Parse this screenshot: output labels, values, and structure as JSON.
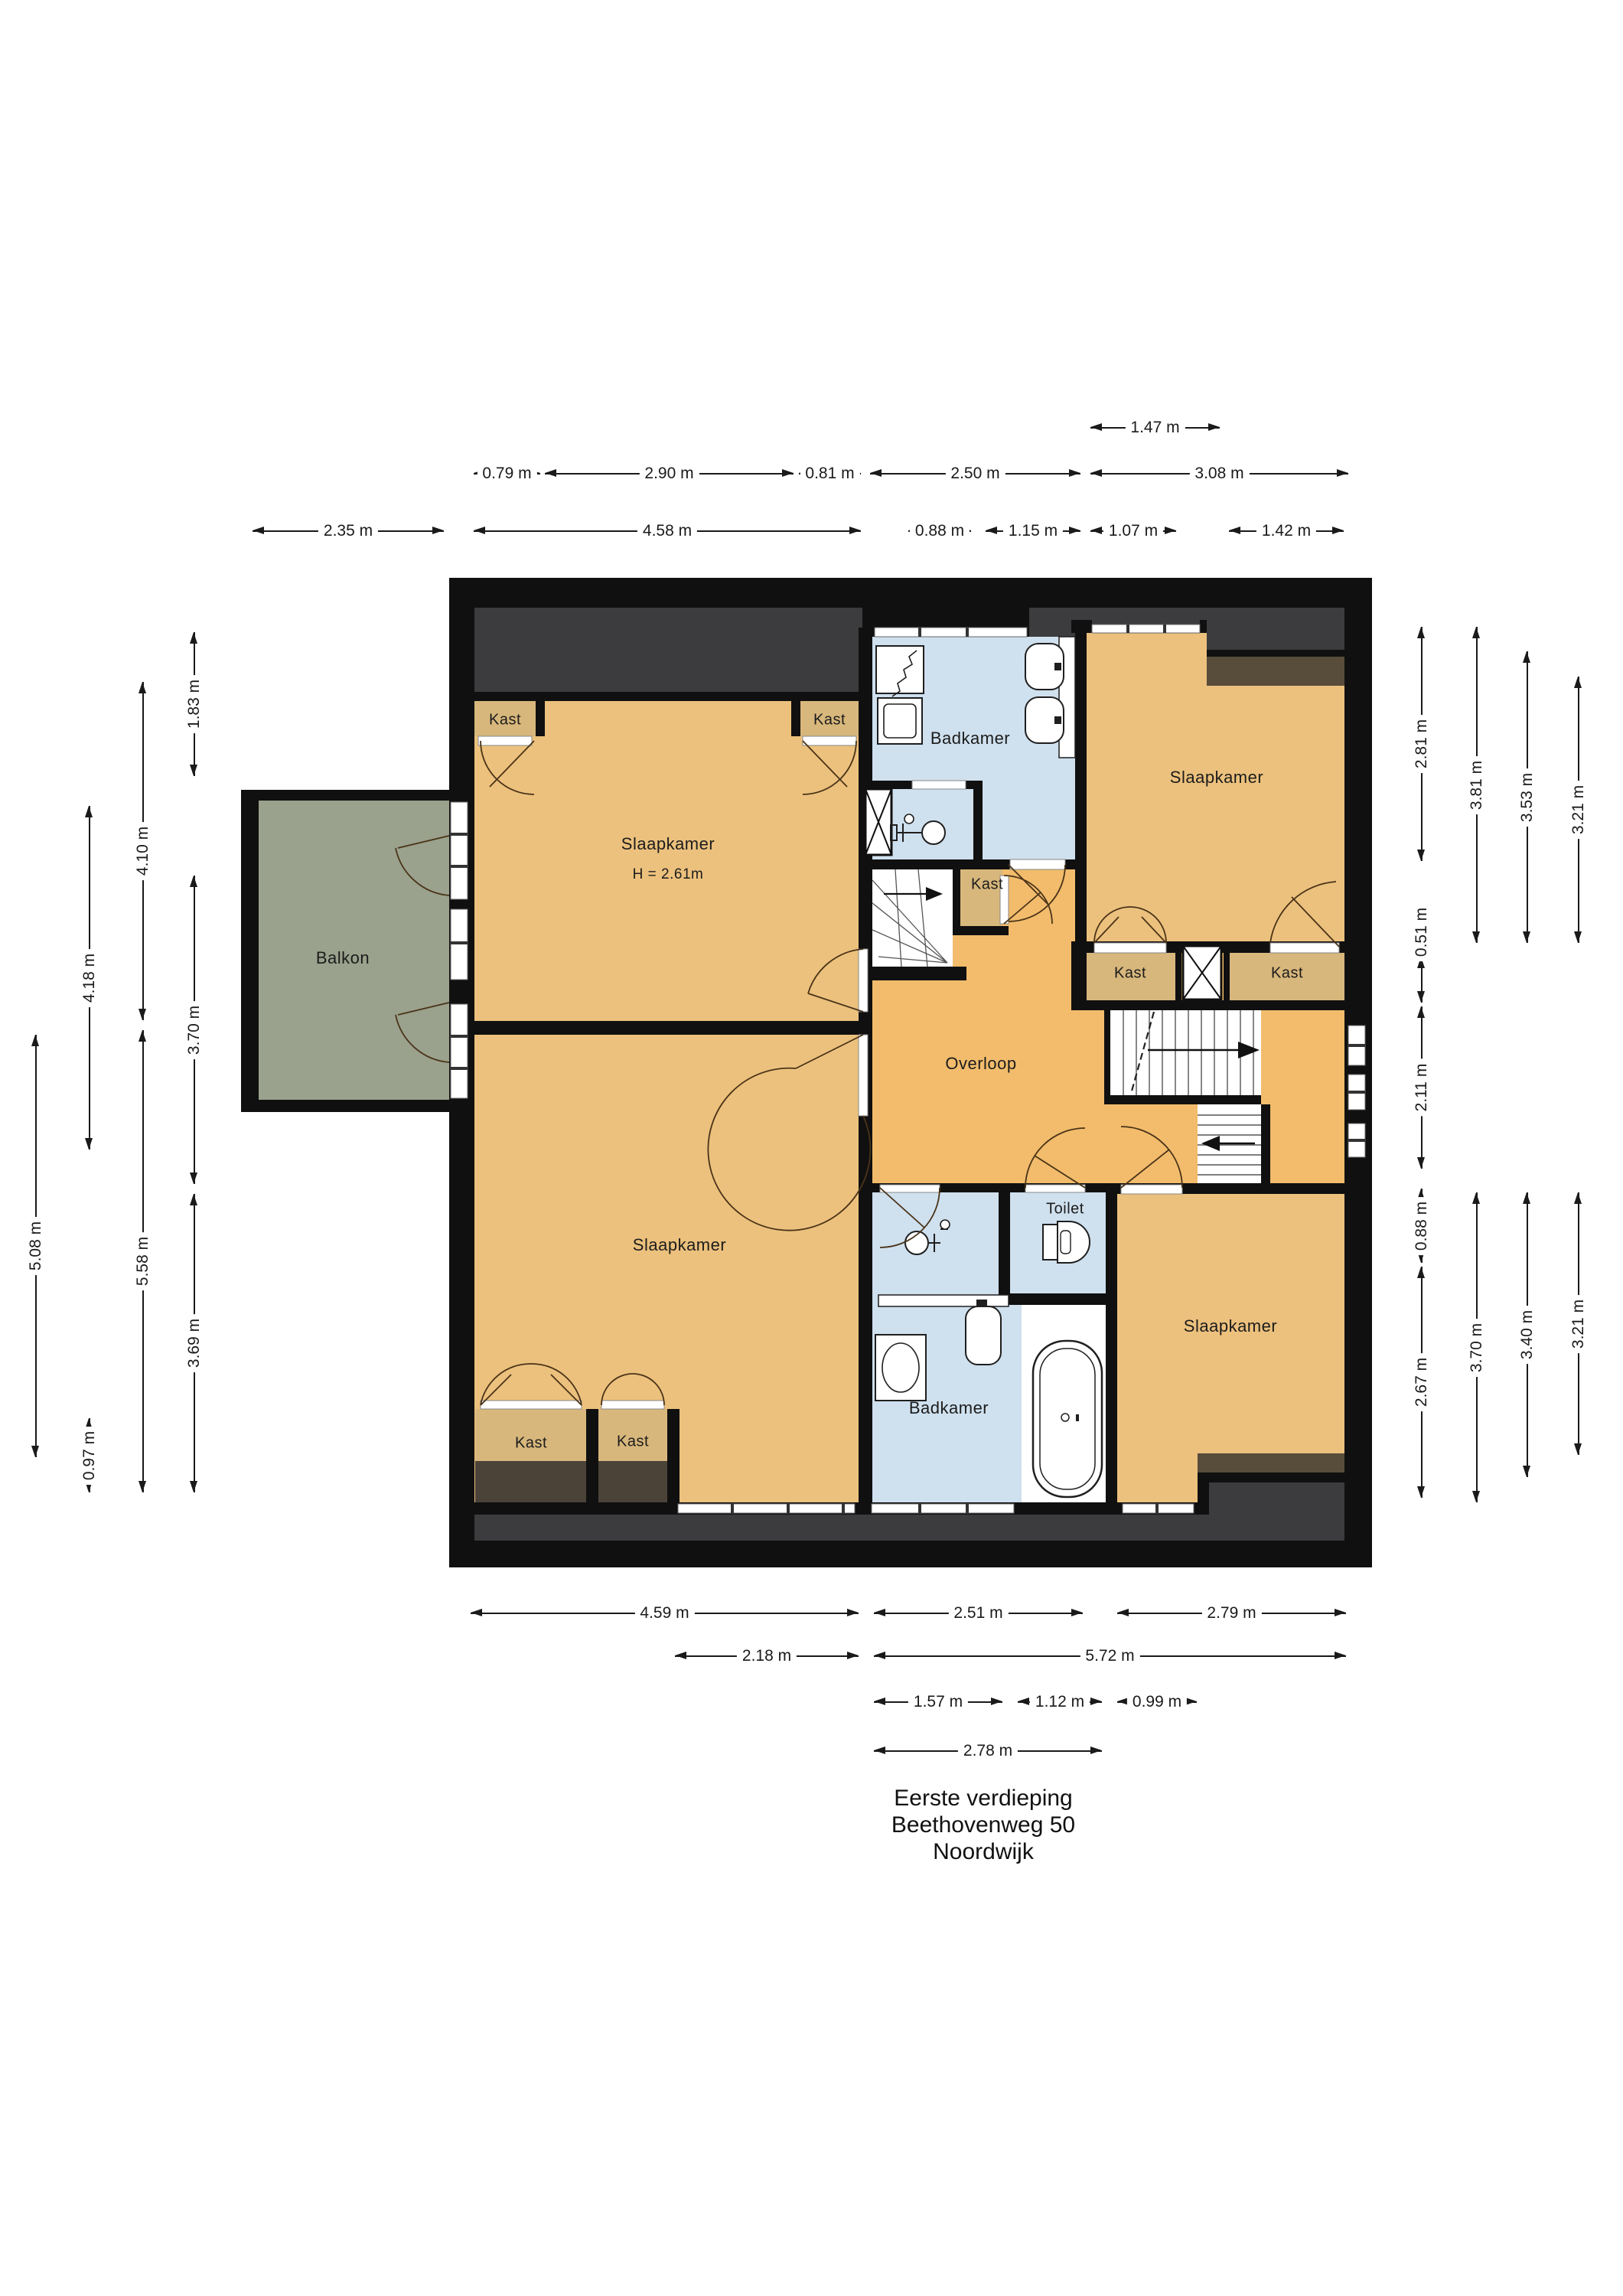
{
  "title": {
    "line1": "Eerste verdieping",
    "line2": "Beethovenweg 50",
    "line3": "Noordwijk"
  },
  "rooms": {
    "slaapkamer_tl": "Slaapkamer",
    "slaapkamer_tl_height": "H = 2.61m",
    "slaapkamer_tr": "Slaapkamer",
    "slaapkamer_bl": "Slaapkamer",
    "slaapkamer_br": "Slaapkamer",
    "badkamer_top": "Badkamer",
    "badkamer_bottom": "Badkamer",
    "overloop": "Overloop",
    "toilet": "Toilet",
    "balkon": "Balkon",
    "kast": "Kast"
  },
  "dimensions": {
    "top": [
      "1.47 m",
      "0.79 m",
      "2.90 m",
      "0.81 m",
      "2.50 m",
      "3.08 m",
      "2.35 m",
      "4.58 m",
      "0.88 m",
      "1.15 m",
      "1.07 m",
      "1.42 m"
    ],
    "bottom": [
      "4.59 m",
      "2.51 m",
      "2.79 m",
      "2.18 m",
      "5.72 m",
      "1.57 m",
      "1.12 m",
      "0.99 m",
      "2.78 m"
    ],
    "left": [
      "1.83 m",
      "4.10 m",
      "4.18 m",
      "3.70 m",
      "5.08 m",
      "5.58 m",
      "3.69 m",
      "0.97 m"
    ],
    "right": [
      "2.81 m",
      "3.81 m",
      "3.53 m",
      "3.21 m",
      "0.51 m",
      "2.11 m",
      "0.88 m",
      "2.67 m",
      "3.70 m",
      "3.40 m",
      "3.21 m"
    ]
  },
  "fixtures": [
    "shower",
    "washing-machine",
    "sink",
    "double-sink",
    "bathtub",
    "toilet-bowl",
    "mixer-tap",
    "stairs-up",
    "stairs-down",
    "winder-stairs",
    "shaft",
    "window",
    "door"
  ],
  "colors": {
    "wall": "#101010",
    "roof": "#3c3c3e",
    "roofbrown": "#584c3a",
    "underbrown": "#4c4338",
    "tan": "#ecc17d",
    "kast": "#d8b77c",
    "hall": "#f2bc6c",
    "blue": "#cfe0ee",
    "balc": "#9aa18c",
    "white": "#ffffff"
  }
}
